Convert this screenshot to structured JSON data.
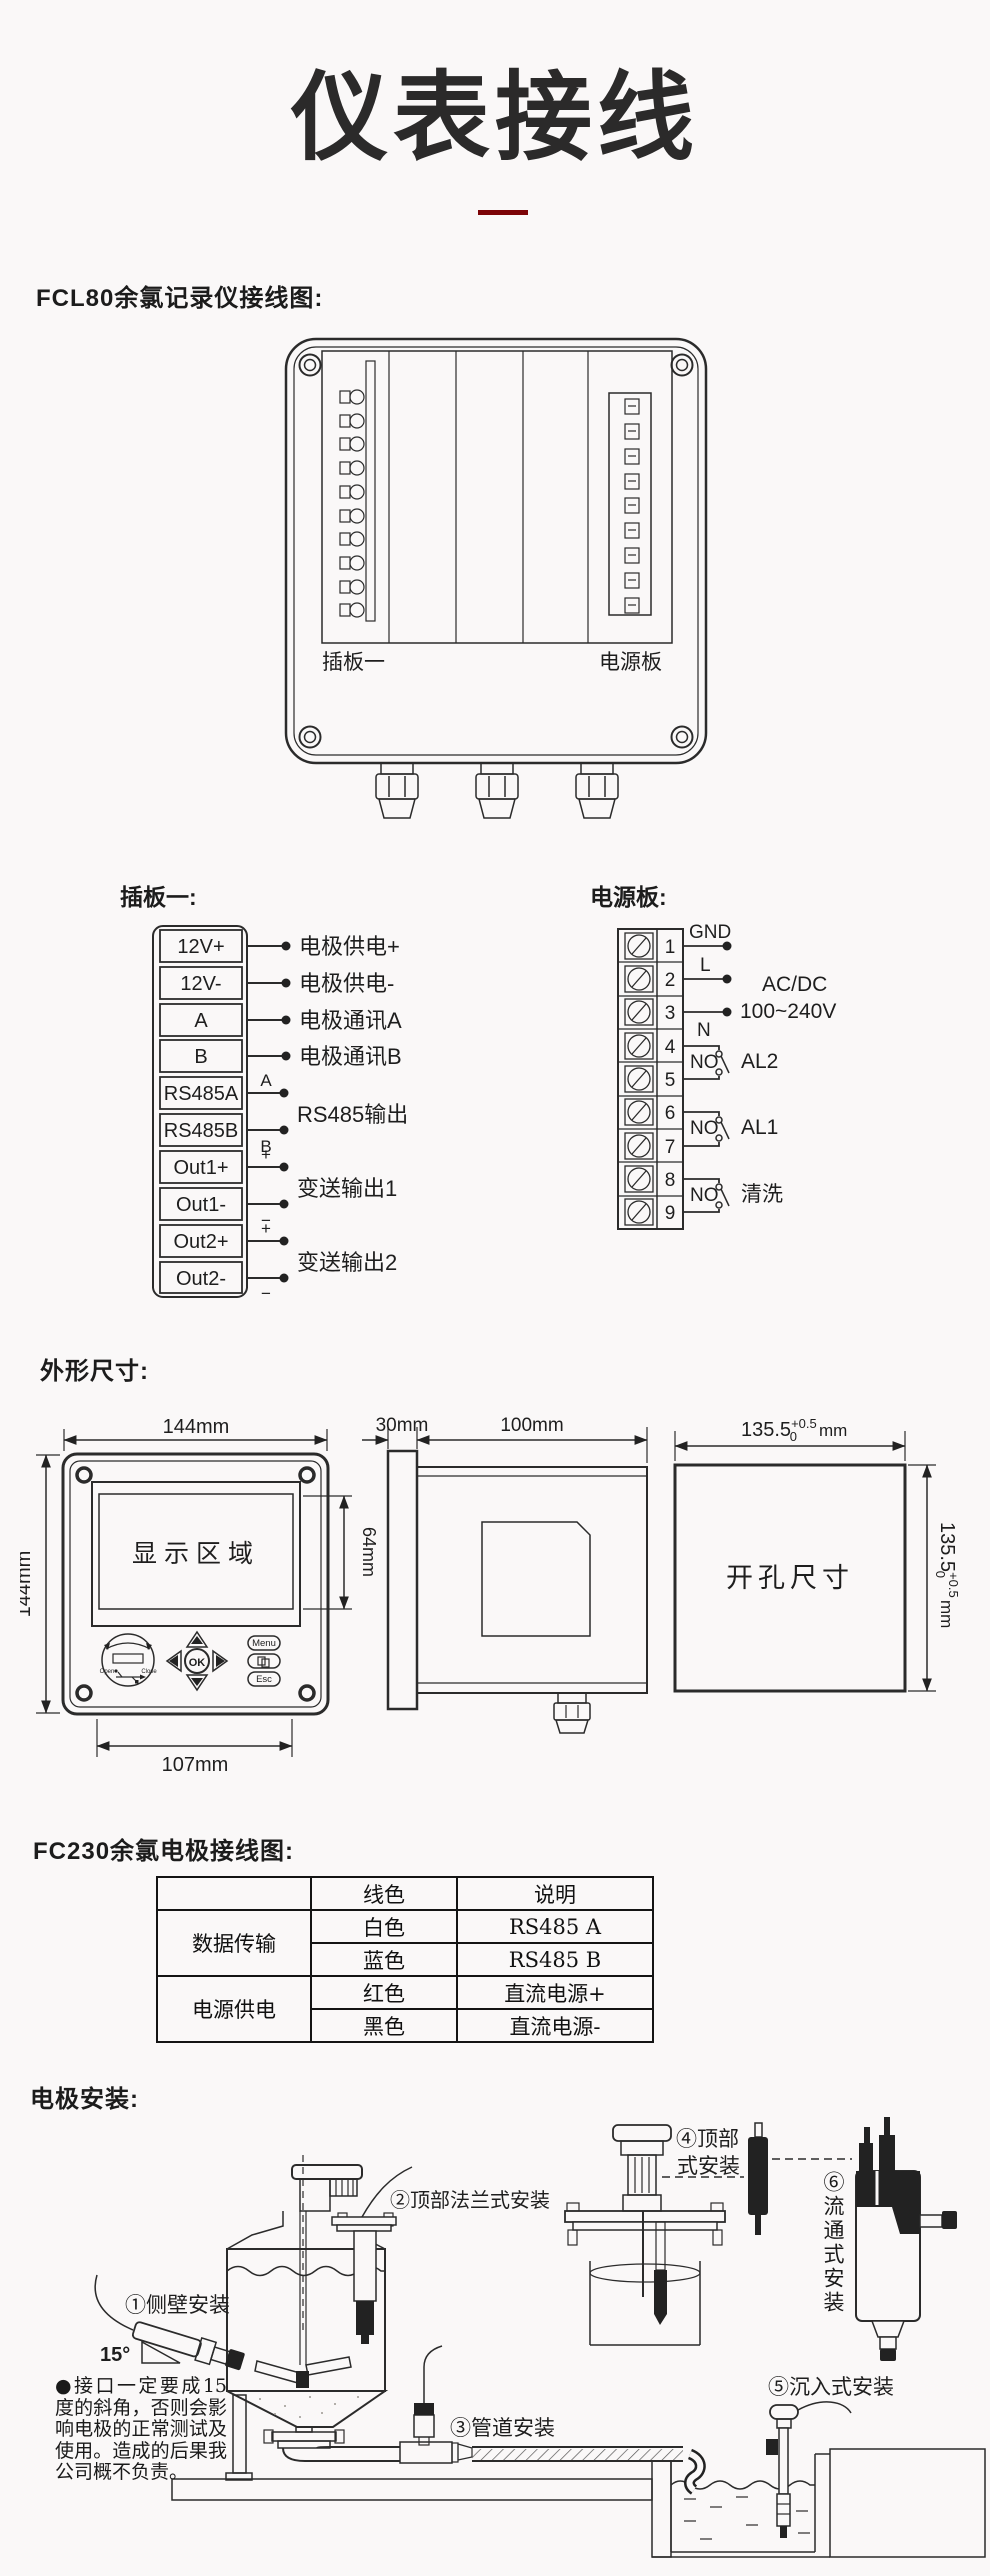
{
  "page": {
    "title": "仪表接线",
    "accent": "#7c0407"
  },
  "fcl80": {
    "heading": "FCL80余氯记录仪接线图:",
    "board_left": "插板一",
    "board_right": "电源板"
  },
  "plugboard": {
    "heading": "插板一:",
    "terminals": [
      "12V+",
      "12V-",
      "A",
      "B",
      "RS485A",
      "RS485B",
      "Out1+",
      "Out1-",
      "Out2+",
      "Out2-"
    ],
    "annotations": [
      {
        "label": "电极供电+"
      },
      {
        "label": "电极供电-"
      },
      {
        "label": "电极通讯A"
      },
      {
        "label": "电极通讯B"
      },
      {
        "label": "RS485输出",
        "sub_top": "A",
        "sub_bottom": "B"
      },
      {
        "label": "变送输出1",
        "sub_top": "+",
        "sub_bottom": "−"
      },
      {
        "label": "变送输出2",
        "sub_top": "+",
        "sub_bottom": "−"
      }
    ]
  },
  "powerboard": {
    "heading": "电源板:",
    "numbers": [
      "1",
      "2",
      "3",
      "4",
      "5",
      "6",
      "7",
      "8",
      "9"
    ],
    "gnd": "GND",
    "line": "L",
    "neutral": "N",
    "supply_1": "AC/DC",
    "supply_2": "100~240V",
    "relays": [
      {
        "contact": "NO",
        "label": "AL2"
      },
      {
        "contact": "NO",
        "label": "AL1"
      },
      {
        "contact": "NO",
        "label": "清洗"
      }
    ]
  },
  "dims": {
    "heading": "外形尺寸:",
    "front_width": "144mm",
    "front_height": "144mm",
    "front_bottom": "107mm",
    "display_label": "显示区域",
    "display_height": "64mm",
    "keys": {
      "ok": "OK",
      "menu": "Menu",
      "esc": "Esc",
      "open": "Open",
      "close": "Close"
    },
    "side_bezel": "30mm",
    "side_depth": "100mm",
    "cutout_label": "开孔尺寸",
    "cutout_value": "135.5",
    "tol_plus": "+0.5",
    "tol_zero": "0",
    "unit": "mm"
  },
  "fc230": {
    "heading": "FC230余氯电极接线图:",
    "headers": [
      "线色",
      "说明"
    ],
    "groups": [
      {
        "name": "数据传输",
        "rows": [
          [
            "白色",
            "RS485 A"
          ],
          [
            "蓝色",
            "RS485 B"
          ]
        ]
      },
      {
        "name": "电源供电",
        "rows": [
          [
            "红色",
            "直流电源+"
          ],
          [
            "黑色",
            "直流电源-"
          ]
        ]
      }
    ]
  },
  "install": {
    "heading": "电极安装:",
    "angle": "15°",
    "label_1": "①侧壁安装",
    "label_2": "②顶部法兰式安装",
    "label_3": "③管道安装",
    "label_4a": "④顶部",
    "label_4b": "式安装",
    "label_5": "⑤沉入式安装",
    "label_6": "⑥流通式安装",
    "note": "●接口一定要成15度的斜角，否则会影响电极的正常测试及使用。造成的后果我公司概不负责。"
  }
}
